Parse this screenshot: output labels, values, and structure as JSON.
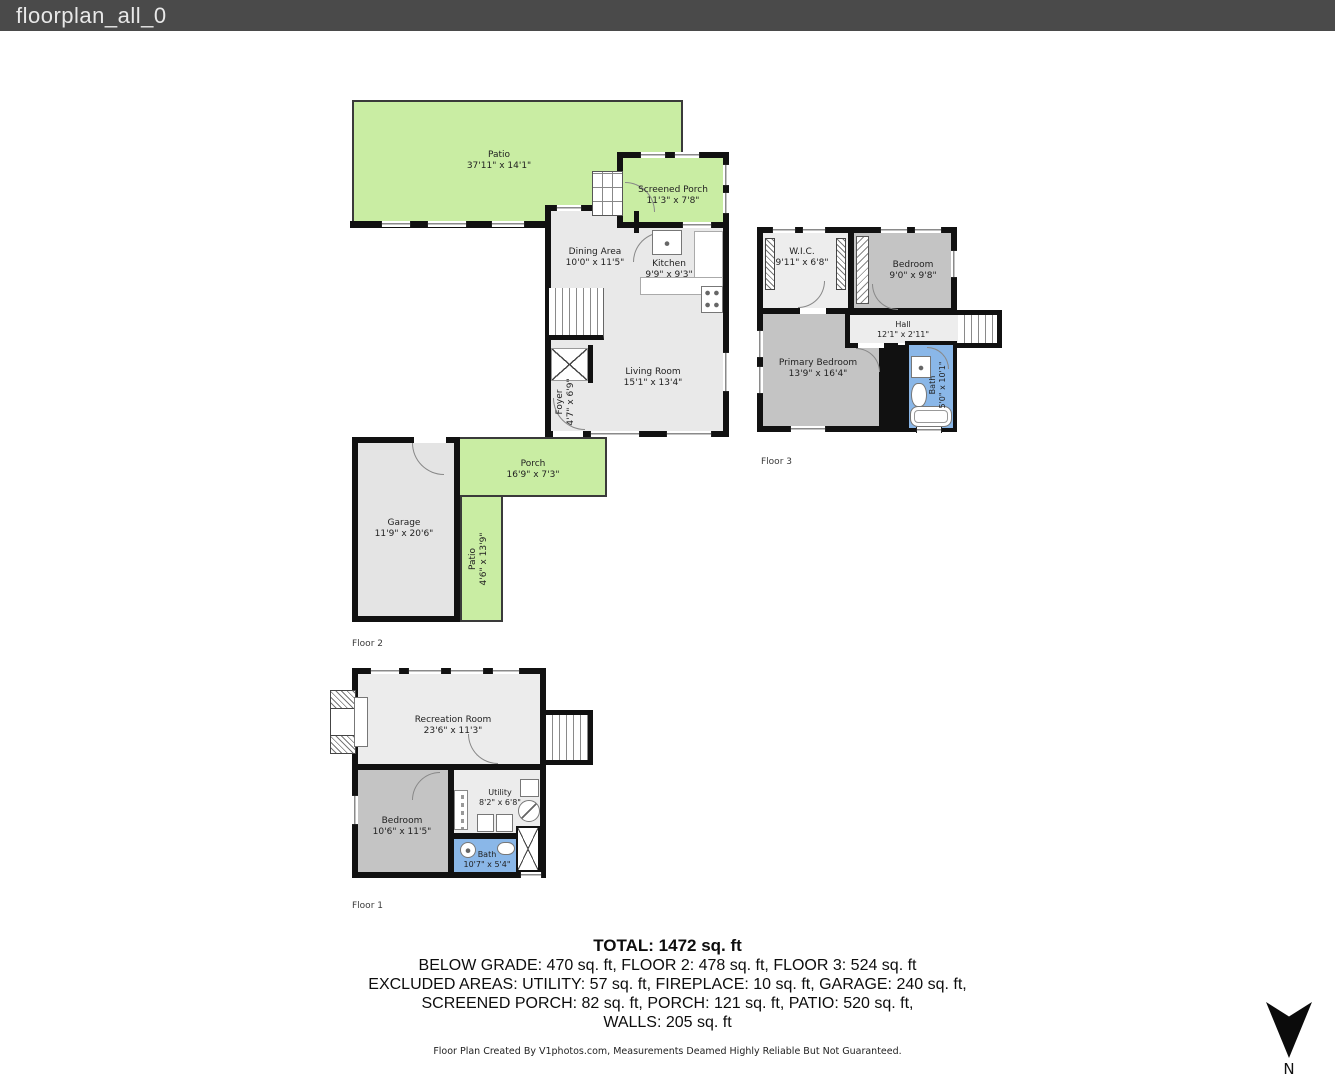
{
  "window": {
    "title": "floorplan_all_0"
  },
  "floor2": {
    "label": "Floor 2",
    "rooms": {
      "patio": {
        "name": "Patio",
        "dims": "37'11\" x 14'1\""
      },
      "screened_porch": {
        "name": "Screened Porch",
        "dims": "11'3\" x 7'8\""
      },
      "dining": {
        "name": "Dining Area",
        "dims": "10'0\" x 11'5\""
      },
      "kitchen": {
        "name": "Kitchen",
        "dims": "9'9\" x 9'3\""
      },
      "living": {
        "name": "Living Room",
        "dims": "15'1\" x 13'4\""
      },
      "foyer": {
        "name": "Foyer",
        "dims": "4'7\" x 6'9\""
      },
      "porch": {
        "name": "Porch",
        "dims": "16'9\" x 7'3\""
      },
      "garage": {
        "name": "Garage",
        "dims": "11'9\" x 20'6\""
      },
      "patio_side": {
        "name": "Patio",
        "dims": "4'6\" x 13'9\""
      }
    }
  },
  "floor3": {
    "label": "Floor 3",
    "rooms": {
      "wic": {
        "name": "W.I.C.",
        "dims": "9'11\" x 6'8\""
      },
      "bedroom": {
        "name": "Bedroom",
        "dims": "9'0\" x 9'8\""
      },
      "hall": {
        "name": "Hall",
        "dims": "12'1\" x 2'11\""
      },
      "primary_bedroom": {
        "name": "Primary Bedroom",
        "dims": "13'9\" x 16'4\""
      },
      "bath": {
        "name": "Bath",
        "dims": "5'0\" x 10'1\""
      }
    }
  },
  "floor1": {
    "label": "Floor 1",
    "rooms": {
      "recreation": {
        "name": "Recreation Room",
        "dims": "23'6\" x 11'3\""
      },
      "bedroom": {
        "name": "Bedroom",
        "dims": "10'6\" x 11'5\""
      },
      "utility": {
        "name": "Utility",
        "dims": "8'2\" x 6'8\""
      },
      "bath": {
        "name": "Bath",
        "dims": "10'7\" x 5'4\""
      }
    }
  },
  "summary": {
    "total": "TOTAL: 1472 sq. ft",
    "lines": [
      "BELOW GRADE: 470 sq. ft, FLOOR 2: 478 sq. ft, FLOOR 3: 524 sq. ft",
      "EXCLUDED AREAS: UTILITY: 57 sq. ft, FIREPLACE: 10 sq. ft, GARAGE: 240 sq. ft,",
      "SCREENED PORCH: 82 sq. ft, PORCH: 121 sq. ft, PATIO: 520 sq. ft,",
      "WALLS: 205 sq. ft"
    ]
  },
  "credit": "Floor Plan Created By V1photos.com, Measurements Deamed Highly Reliable But Not Guaranteed.",
  "compass": {
    "label": "N"
  },
  "colors": {
    "outdoor_green": "#c9eda3",
    "room_gray": "#e9e9e9",
    "bedroom_gray": "#c4c4c4",
    "bath_blue": "#8ab7e8",
    "wall_black": "#111111",
    "header_bg": "#4a4a4a"
  }
}
